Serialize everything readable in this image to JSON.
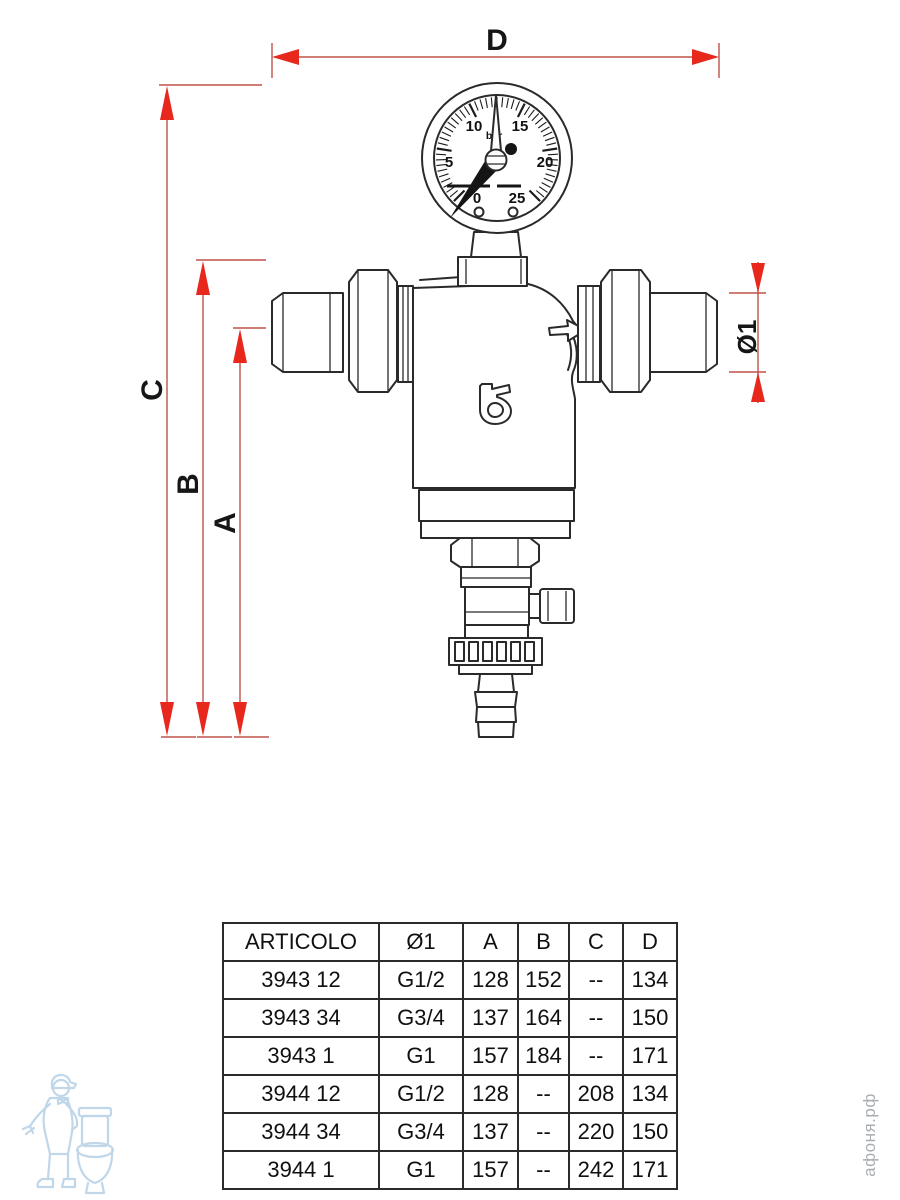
{
  "diagram": {
    "dimensions": {
      "d": "D",
      "c": "C",
      "b": "B",
      "a": "A",
      "diameter": "Ø1"
    },
    "gauge": {
      "unit": "bar",
      "scale": [
        "0",
        "5",
        "10",
        "15",
        "20",
        "25"
      ]
    }
  },
  "table": {
    "headers": [
      "ARTICOLO",
      "Ø1",
      "A",
      "B",
      "C",
      "D"
    ],
    "rows": [
      [
        "3943 12",
        "G1/2",
        "128",
        "152",
        "--",
        "134"
      ],
      [
        "3943 34",
        "G3/4",
        "137",
        "164",
        "--",
        "150"
      ],
      [
        "3943 1",
        "G1",
        "157",
        "184",
        "--",
        "171"
      ],
      [
        "3944 12",
        "G1/2",
        "128",
        "--",
        "208",
        "134"
      ],
      [
        "3944 34",
        "G3/4",
        "137",
        "--",
        "220",
        "150"
      ],
      [
        "3944 1",
        "G1",
        "157",
        "--",
        "242",
        "171"
      ]
    ]
  },
  "watermark": {
    "site_text": "афоня.рф"
  },
  "colors": {
    "arrow_red": "#e8271d",
    "dim_line_red": "#c0524a",
    "drawing_ink": "#2a2a2a",
    "watermark_blue": "#b6d0e6",
    "watermark_gray": "#a8adb2"
  }
}
